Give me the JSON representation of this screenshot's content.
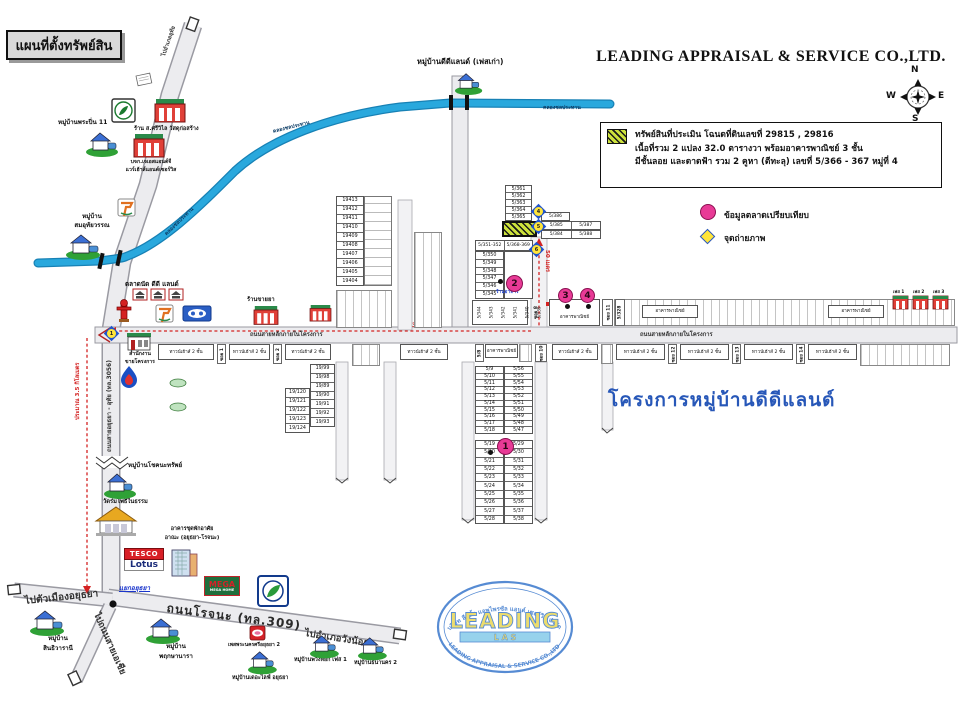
{
  "title": "แผนที่ตั้งทรัพย์สิน",
  "company": "LEADING APPRAISAL & SERVICE CO.,LTD.",
  "compass": {
    "n": "N",
    "e": "E",
    "s": "S",
    "w": "W"
  },
  "legend": {
    "l1": "ทรัพย์สินที่ประเมิน โฉนดที่ดินเลขที่ 29815 , 29816",
    "l2": "เนื้อที่รวม 2 แปลง 32.0 ตารางวา พร้อมอาคารพาณิชย์ 3 ชั้น",
    "l3": "มีชั้นลอย และดาดฟ้า รวม 2 คูหา (ตีทะลุ) เลขที่ 5/366 - 367 หมู่ที่ 4",
    "market": "ข้อมูลตลาดเปรียบเทียบ",
    "photo": "จุดถ่ายภาพ"
  },
  "roads": {
    "hwy3056": "ถนนสายอยุธยา - อุทัย (ทล.3056)",
    "to_uthai": "ไปอำเภออุทัย",
    "main": "ถนนสายหลักภายในโครงการ",
    "rojana": "ถนนโรจนะ (ทล.309)",
    "to_city": "ไปตัวเมืองอยุธยา",
    "to_asia": "ไปถนนสายเอเชีย",
    "to_wangnoi": "ไปอำเภอวังน้อย",
    "canal": "คลองชลประทาน",
    "junction": "แยกอยุธยา"
  },
  "distances": {
    "km": "ประมาณ 3.5 กิโลเมตร",
    "m300": "300 เมตร",
    "m50": "50 เมตร"
  },
  "project_name": "โครงการหมู่บ้านดีดีแลนด์",
  "poi": {
    "dd_old": "หมู่บ้านดีดีแลนด์ (เฟสเก่า)",
    "prapin": "หมู่บ้านพระปิ่น 11",
    "sriwilai": "ร้าน ส.ศรีวิไล วัสดุก่อสร้าง",
    "jsk1": "บจก.เจเอสแอนด์จี",
    "jsk2": "แวร์เฮ้าส์แอนด์เซอร์วิส",
    "samuthai1": "หมู่บ้าน",
    "samuthai2": "สมอุทัยวรรณ",
    "market": "ตลาดนัด ดีดี แลนด์",
    "pharmacy": "ร้านขายยา",
    "office1": "สำนักงาน",
    "office2": "ขายโครงการ",
    "choknathap": "หมู่บ้านโชคนะทรัพย์",
    "wat": "วัดร่มโพธิ์ในธรรม",
    "condo1": "อาคารชุดพักอาศัย",
    "condo2": "อาณะ (อยุธยา-โรจนะ)",
    "tesco": "TESCO",
    "lotus": "Lotus",
    "mega": "MEGA",
    "mega_sub": "MEGA HOME",
    "sinthi1": "หมู่บ้าน",
    "sinthi2": "สินธิวารานี",
    "phruksa1": "หมู่บ้าน",
    "phruksa2": "พฤกษานารา",
    "esso": "เพสพระนครศรีอยุธยา 2",
    "thelife": "หมู่บ้านเดอะไลฟ์ อยุธยา",
    "puangyok": "หมู่บ้านพวงหยก เฟส 1",
    "thananakorn": "หมู่บ้านธนานคร 2",
    "restaurant": "ร้านอาหาร",
    "shophouse": "อาคารพาณิชย์",
    "townhouse": "ทาวน์เฮ้าส์ 2 ชั้น",
    "phase1": "เฟส 1",
    "phase2": "เฟส 2",
    "phase3": "เฟส 3"
  },
  "sois": {
    "s1": "ซอย 1",
    "s2": "ซอย 2",
    "s8": "ซอย 8",
    "s10": "ซอย 10",
    "s11": "ซอย 11",
    "s12": "ซอย 12",
    "s13": "ซอย 13",
    "s14": "ซอย 14"
  },
  "plots": {
    "c19400": [
      "19413",
      "19412",
      "19411",
      "19410",
      "19409",
      "19408",
      "19407",
      "19406",
      "19405",
      "19404"
    ],
    "c19l": [
      "19/120",
      "19/121",
      "19/122",
      "19/123",
      "19/124"
    ],
    "c19r": [
      "19/99",
      "19/98",
      "19/89",
      "19/90",
      "19/91",
      "19/92",
      "19/93"
    ],
    "c5361": [
      "5/361",
      "5/362",
      "5/363",
      "5/364",
      "5/365"
    ],
    "g386": [
      "5/386"
    ],
    "g385": [
      "5/385",
      "5/387"
    ],
    "g384": [
      "5/384",
      "5/388"
    ],
    "hdrC": [
      "5/351-352",
      "5/368-369"
    ],
    "cCl": [
      "5/350",
      "5/349",
      "5/348",
      "5/347",
      "5/346",
      "5/345"
    ],
    "dAl": [
      "5/9",
      "5/10",
      "5/11",
      "5/12",
      "5/13",
      "5/14",
      "5/15",
      "5/16",
      "5/17",
      "5/18"
    ],
    "dAr": [
      "5/56",
      "5/55",
      "5/54",
      "5/53",
      "5/52",
      "5/51",
      "5/50",
      "5/49",
      "5/48",
      "5/47"
    ],
    "dBl": [
      "5/19",
      "5/20",
      "5/21",
      "5/22",
      "5/23",
      "5/24",
      "5/25",
      "5/26",
      "5/27",
      "5/28"
    ],
    "dBr": [
      "5/29",
      "5/30",
      "5/31",
      "5/32",
      "5/33",
      "5/34",
      "5/35",
      "5/36",
      "5/37",
      "5/38"
    ],
    "s533": [
      "5/344",
      "5/343",
      "5/342",
      "5/341",
      "5/340",
      "5/339",
      "5/338",
      "5/337"
    ],
    "p58": "5/8",
    "p5328": "5/328"
  },
  "markers": {
    "pink": [
      "1",
      "2",
      "3",
      "4"
    ],
    "photo": [
      "1",
      "4",
      "5",
      "6"
    ]
  },
  "watermark": {
    "thai": "บริษัท ลีดดิ้ง แอพไพรซัล แอนด์ เซอร์วิส จำกัด",
    "name": "LEADING",
    "las": "L A S",
    "eng": "LEADING APPRAISAL & SERVICE CO.,LTD"
  },
  "colors": {
    "canal": "#29a8dd",
    "road_fill": "#e9e9ec",
    "route_red": "#d42222",
    "pink": "#e83a96",
    "photo_yellow": "#ffe53a",
    "project_blue": "#2757b8",
    "subject_hatch": "#cde23c"
  }
}
